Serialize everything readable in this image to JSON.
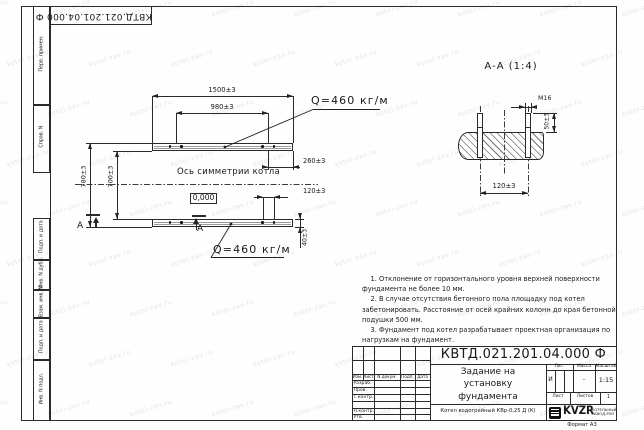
{
  "watermark": {
    "text": "kotel-zav.ru"
  },
  "sheet": {
    "top_doc_number": "КВТД.021.201.04.000 Ф",
    "side_labels": [
      "Перв. примен.",
      "Справ. N",
      "Подп. и дата",
      "Инв. N дубл.",
      "Взам. инв. N",
      "Подп. и дата",
      "Инв. N подл."
    ],
    "format_note": "Формат А3"
  },
  "plan_view": {
    "dims": {
      "overall_length": "1500±3",
      "bolt_group_spacing": "980±3",
      "end_offset": "260±3",
      "bolt_pair_spacing": "120±3",
      "beam_width": "40±3",
      "outer_width": "780±3",
      "inner_width": "700±3"
    },
    "load_top": "Q=460 кг/м",
    "load_bottom": "Q=460 кг/м",
    "axis_label": "Ось симметрии котла",
    "elevation": "0,000",
    "section_mark": "А"
  },
  "section_view": {
    "title": "А-А (1:4)",
    "thread": "М16",
    "dim_protrusion": "50±3",
    "dim_spacing": "120±3"
  },
  "notes": {
    "lines": [
      "    1. Отклонение от горизонтального уровня верхней поверхности",
      "фундамента не более 10 мм.",
      "    2. В случае отсутствия бетонного пола площадку под котел",
      "забетонировать. Расстояние от осей крайних колонн до края бетонной",
      "подушки 500 мм.",
      "    3. Фундамент под котел разрабатывает проектная организация по",
      "нагрузкам на фундамент."
    ]
  },
  "title_block": {
    "doc_number": "КВТД.021.201.04.000 Ф",
    "title_lines": [
      "Задание на",
      "установку",
      "фундамента"
    ],
    "product_name": "Котел водогрейный КВр-0,25 Д (К)",
    "header_cols": [
      "Изм.",
      "Лист",
      "N докум.",
      "Подп.",
      "Дата"
    ],
    "signature_rows": [
      "Разраб.",
      "Пров.",
      "Т.контр.",
      "",
      "Н.контр.",
      "Утв."
    ],
    "lit_label": "Лит.",
    "lit_value": "И",
    "mass_label": "Масса",
    "mass_value": "-",
    "scale_label": "Масштаб",
    "scale_value": "1:15",
    "sheet_label": "Лист",
    "sheets_label": "Листов",
    "sheets_value": "1",
    "logo_text": "KVZR",
    "company": [
      "КОТЕЛЬНЫЙ",
      "ЗАВОД-РЭП"
    ]
  }
}
